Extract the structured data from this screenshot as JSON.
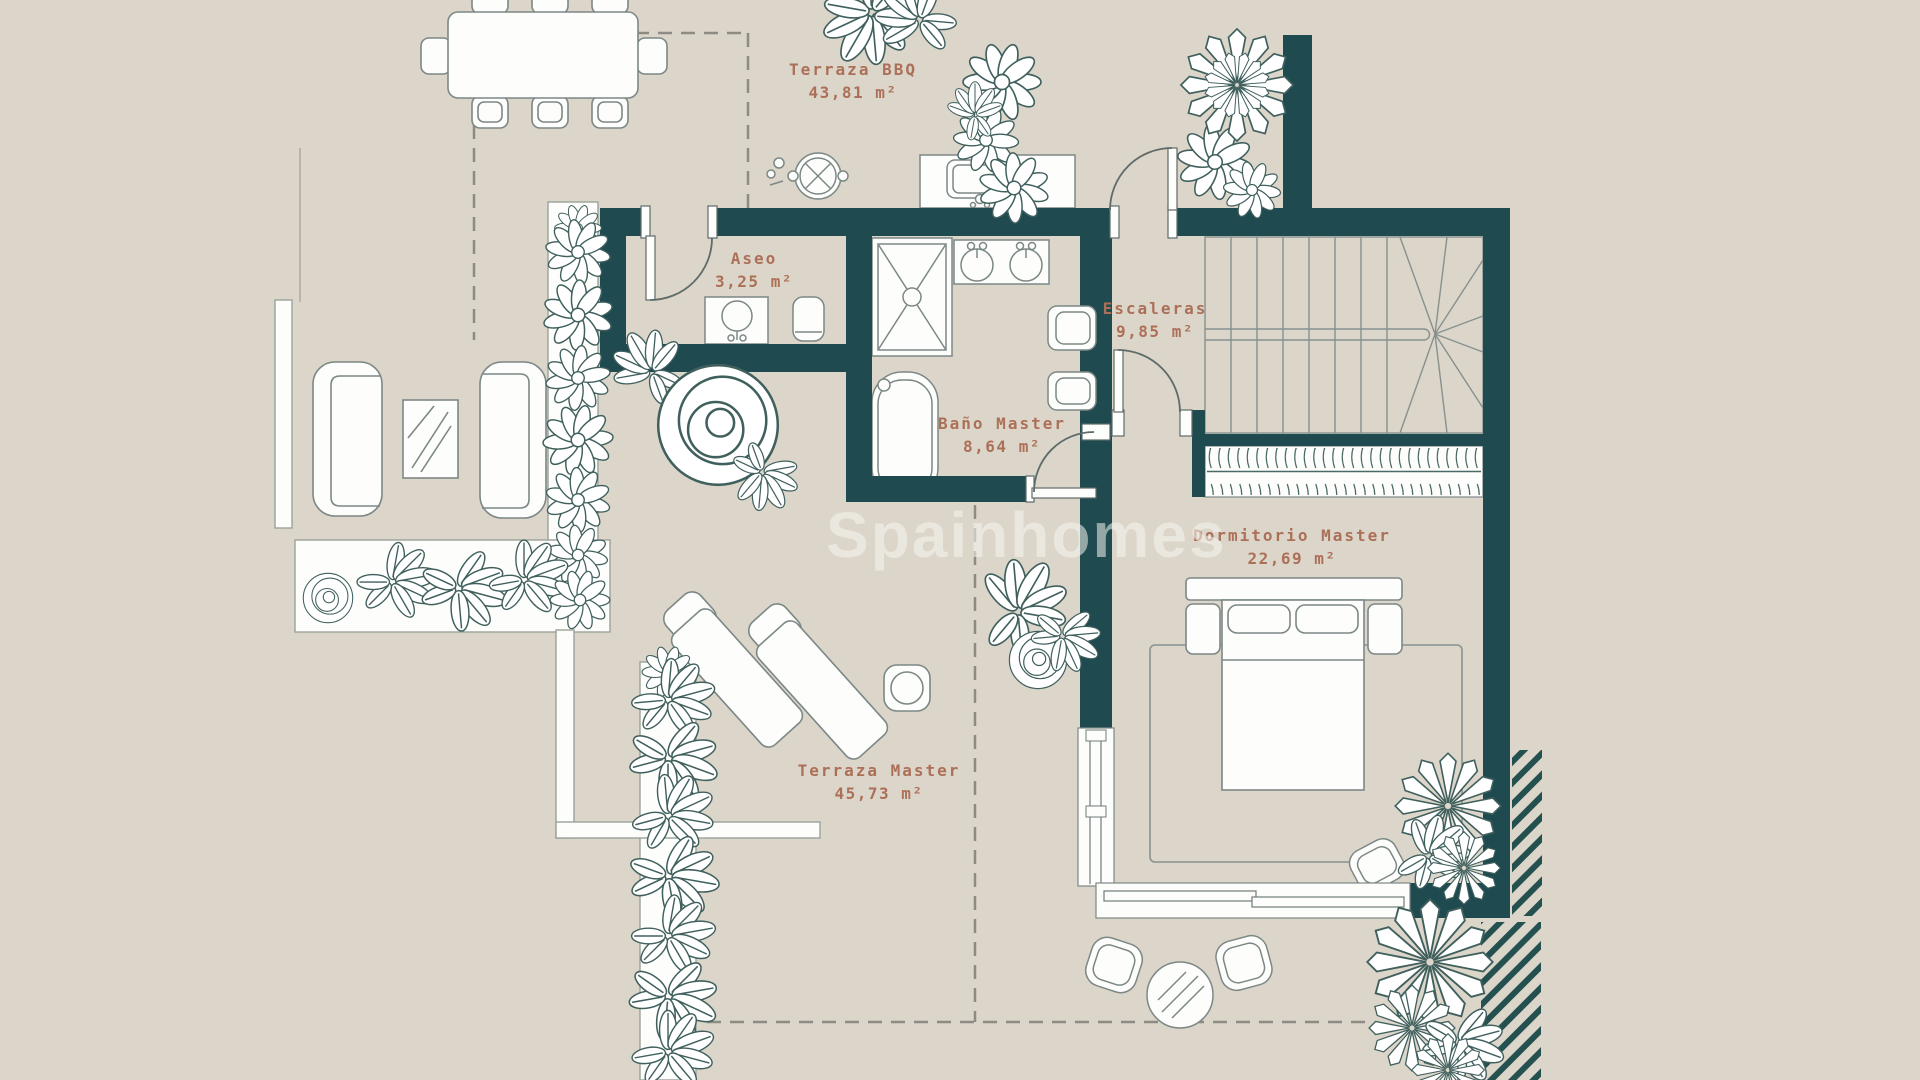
{
  "watermark": {
    "text": "Spainhomes"
  },
  "rooms": [
    {
      "name": "Terraza BBQ",
      "area": "43,81 m²"
    },
    {
      "name": "Aseo",
      "area": "3,25 m²"
    },
    {
      "name": "Escaleras",
      "area": "9,85 m²"
    },
    {
      "name": "Baño Master",
      "area": "8,64 m²"
    },
    {
      "name": "Dormitorio Master",
      "area": "22,69 m²"
    },
    {
      "name": "Terraza Master",
      "area": "45,73 m²"
    }
  ],
  "colors": {
    "background": "#DCD5C9",
    "wall": "#1F4A50",
    "label": "#AC7058",
    "furniture_outline": "#7C8886",
    "plant_outline": "#40605E"
  }
}
